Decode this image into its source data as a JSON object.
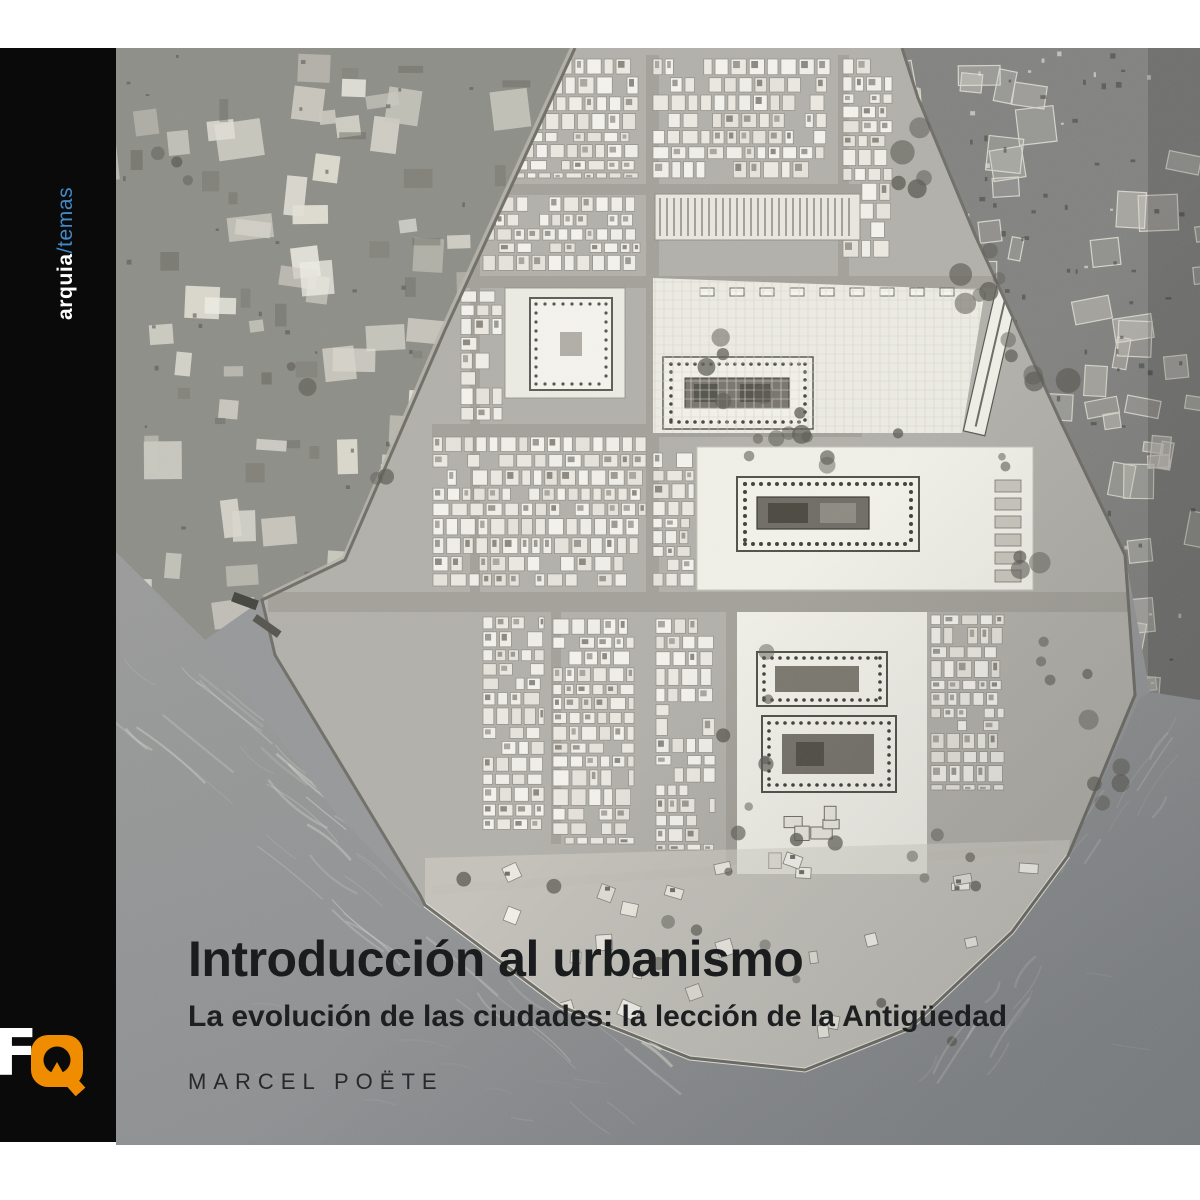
{
  "spine": {
    "brand_bold": "arquia",
    "brand_slash": "/",
    "brand_light": "temas",
    "bar_color": "#0a0a0a",
    "temas_color": "#4189c7"
  },
  "logo": {
    "f": "F",
    "q": "Q",
    "orange": "#f08c00"
  },
  "cover": {
    "title": "Introducción al urbanismo",
    "subtitle": "La evolución de las ciudades: la lección de la Antigüedad",
    "author": "MARCEL POËTE",
    "title_color": "#1a1c1d"
  },
  "cover_image": "aerial-photo-of-ancient-city-plan-model-with-sea",
  "colors": {
    "page_background": "#ffffff",
    "photo_base_gray": "#96989a",
    "city_parchment": "#b2b0aa",
    "sea_gray": "#8d9092"
  }
}
